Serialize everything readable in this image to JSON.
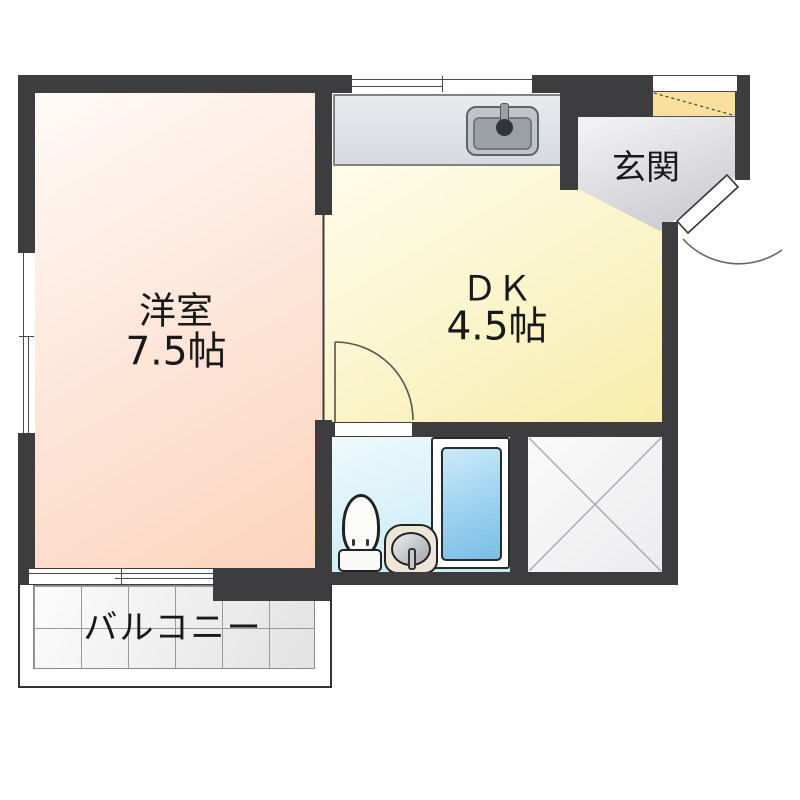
{
  "floorplan": {
    "rooms": {
      "western_room": {
        "label": "洋室",
        "size": "7.5帖"
      },
      "dining_kitchen": {
        "label": "ＤＫ",
        "size": "4.5帖"
      },
      "entrance": {
        "label": "玄関"
      },
      "balcony": {
        "label": "バルコニー"
      }
    },
    "fixtures": {
      "kitchen_sink": "kitchen-sink-icon",
      "toilet": "toilet-icon",
      "washbasin": "washbasin-icon",
      "bathtub": "bathtub-icon",
      "storage_cross": "storage-x-icon",
      "shoe_cabinet": "shoe-cabinet-icon",
      "entrance_door": "door-swing-icon",
      "dk_door": "door-swing-icon",
      "windows": "sliding-window-icon"
    },
    "colors": {
      "wall": "#3d3d3f",
      "western_room_floor": "#fbd8c4",
      "dk_floor": "#f8efb4",
      "entrance_floor": "#d6d6da",
      "shoe_cabinet": "#fbdf9e",
      "bathroom_floor": "#d8f1f8",
      "bathtub": "#8ec7ea",
      "counter": "#dfe3e6",
      "balcony_floor": "#ebebeb"
    }
  }
}
